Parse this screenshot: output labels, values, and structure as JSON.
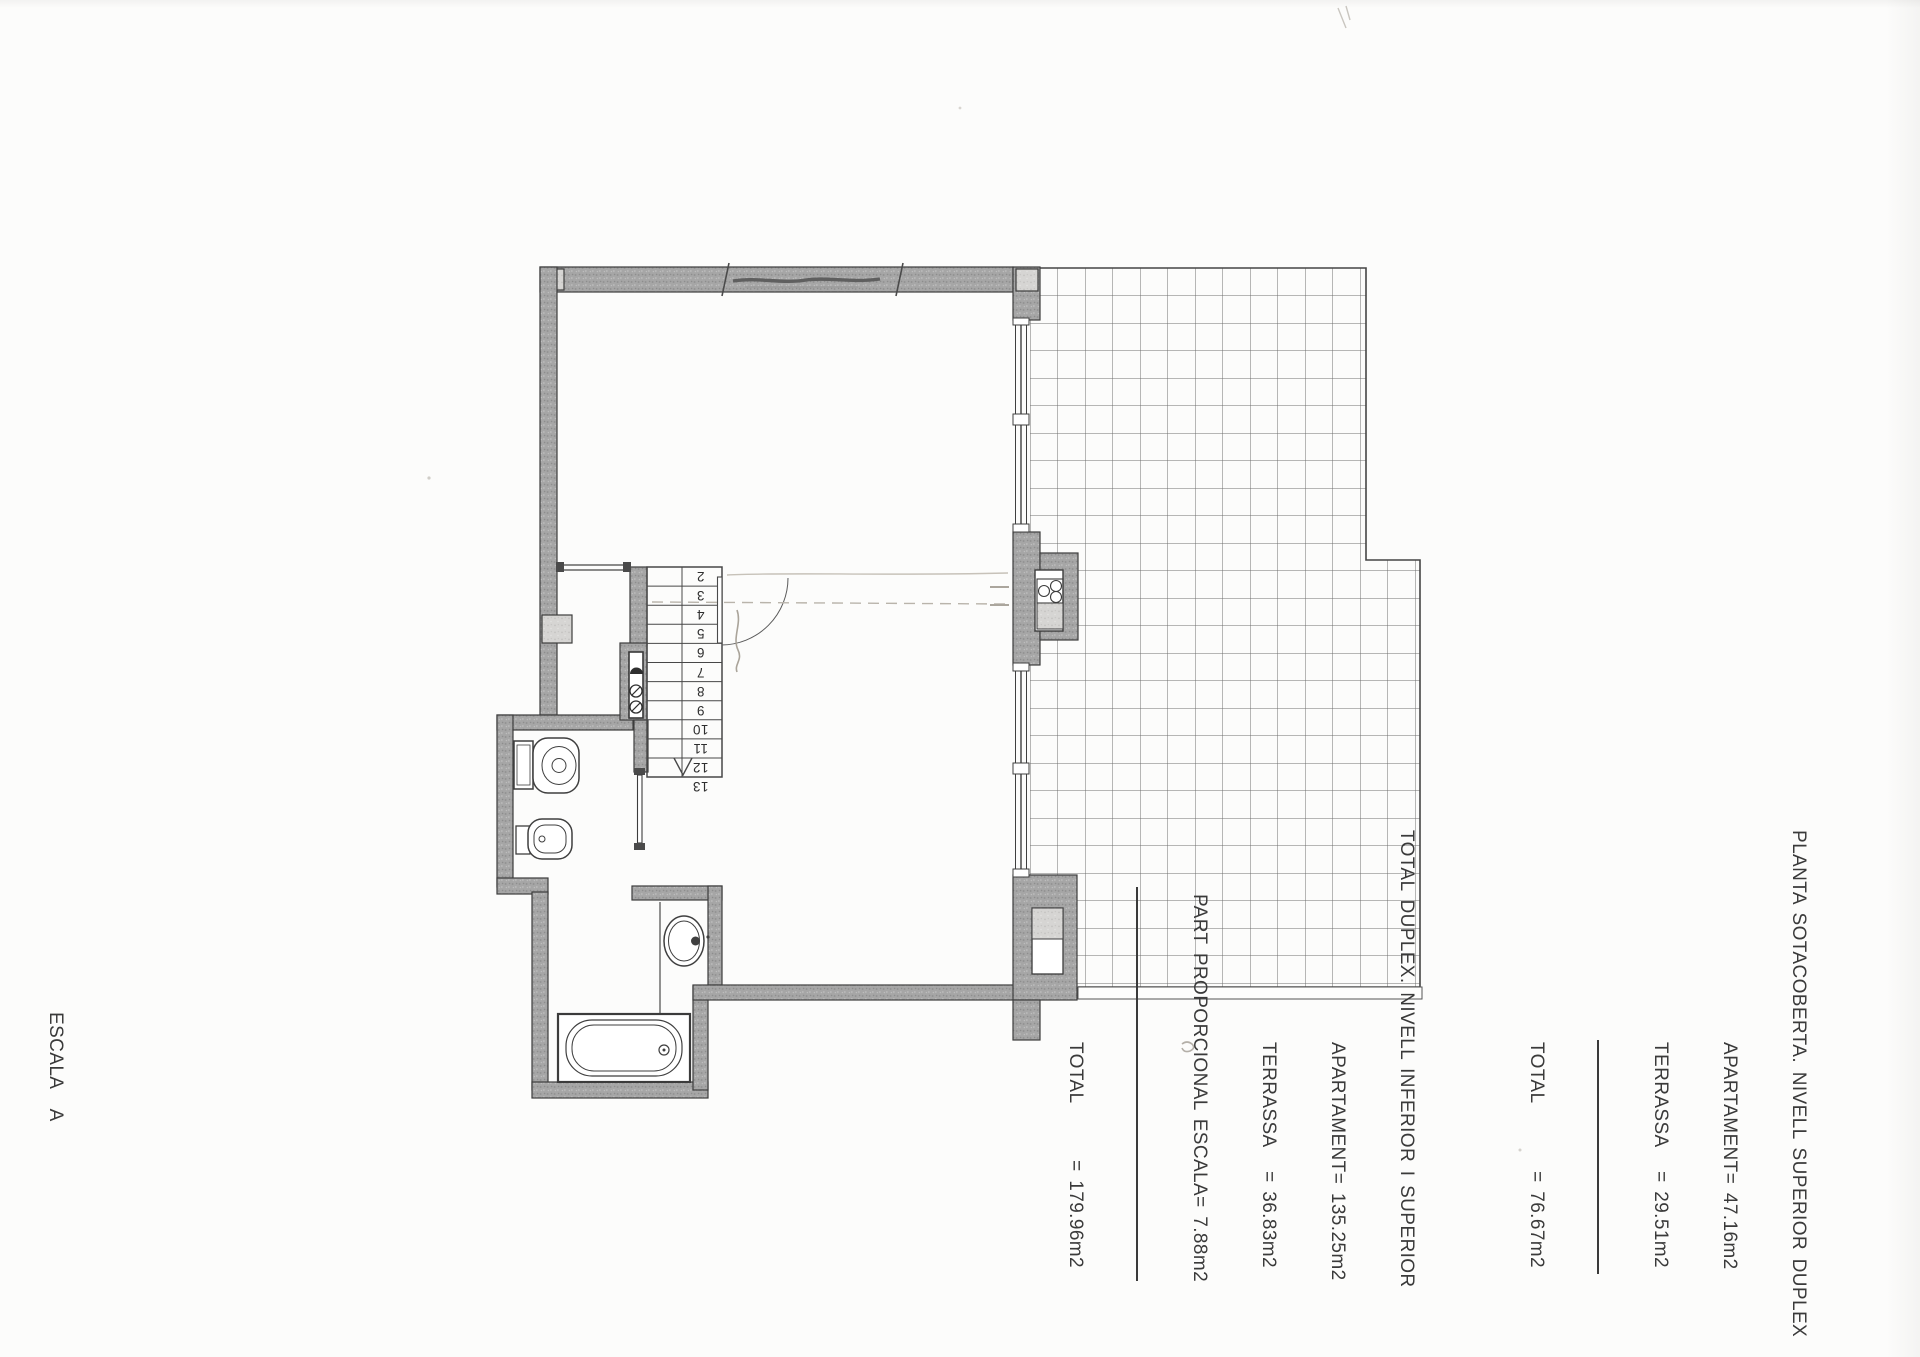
{
  "summary_upper": {
    "title": "PLANTA SOTACOBERTA. NIVELL SUPERIOR DUPLEX",
    "rows": [
      {
        "label": "APARTAMENT",
        "value": "= 47.16m2"
      },
      {
        "label": "TERRASSA",
        "value": "= 29.51m2"
      }
    ],
    "total": {
      "label": "TOTAL",
      "value": "= 76.67m2"
    }
  },
  "summary_total": {
    "title": "TOTAL DUPLEX. NIVELL INFERIOR I SUPERIOR",
    "rows": [
      {
        "label": "APARTAMENT",
        "value": "= 135.25m2"
      },
      {
        "label": "TERRASSA",
        "value": "= 36.83m2"
      },
      {
        "label": "PART PROPORCIONAL ESCALA",
        "value": "= 7.88m2"
      }
    ],
    "total": {
      "label": "TOTAL",
      "value": "= 179.96m2"
    }
  },
  "drawing_label": {
    "lines": [
      "ESCALA  A",
      "PLANTA SOTACOBERTA. PORTA 1",
      "DUPLEX NIVELL SUPERIOR"
    ]
  },
  "plan": {
    "stair_steps": [
      "2",
      "3",
      "4",
      "5",
      "6",
      "7",
      "8",
      "9",
      "10",
      "11",
      "12",
      "13"
    ],
    "colors": {
      "wall": "#a3a3a3",
      "wall_light": "#d4d3d1",
      "line": "#3d3d3d",
      "tile_line": "#6f6f6f",
      "pencil": "#b9b4ab"
    }
  }
}
